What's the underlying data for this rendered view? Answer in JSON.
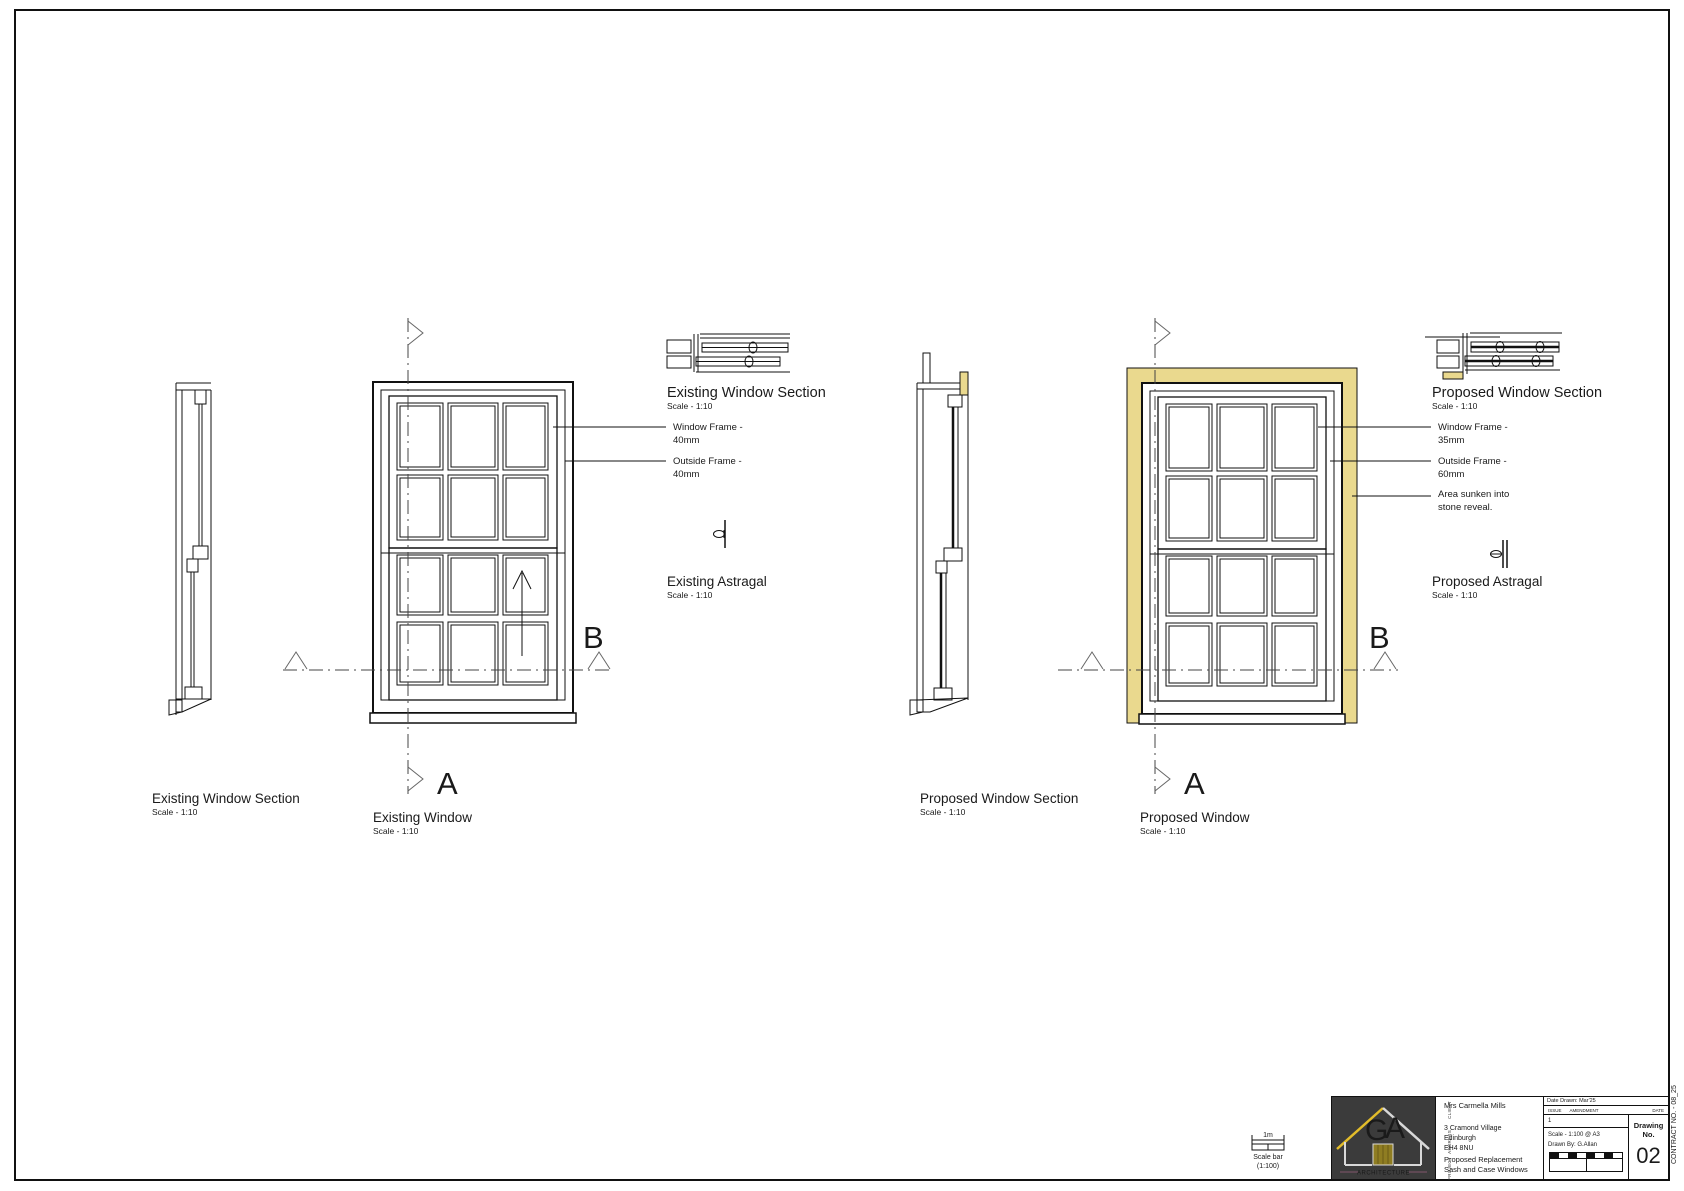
{
  "sheet": {
    "contract_no": "CONTRACT NO. - 08_25"
  },
  "existing": {
    "section_side": {
      "title": "Existing Window Section",
      "scale": "Scale - 1:10"
    },
    "window": {
      "title": "Existing Window",
      "scale": "Scale - 1:10"
    },
    "section_top": {
      "title": "Existing Window Section",
      "scale": "Scale - 1:10"
    },
    "notes": {
      "window_frame_line1": "Window Frame -",
      "window_frame_line2": "40mm",
      "outside_frame_line1": "Outside Frame -",
      "outside_frame_line2": "40mm"
    },
    "astragal": {
      "title": "Existing Astragal",
      "scale": "Scale - 1:10"
    }
  },
  "proposed": {
    "section_side": {
      "title": "Proposed Window Section",
      "scale": "Scale - 1:10"
    },
    "window": {
      "title": "Proposed Window",
      "scale": "Scale - 1:10"
    },
    "section_top": {
      "title": "Proposed Window Section",
      "scale": "Scale - 1:10"
    },
    "notes": {
      "window_frame_line1": "Window Frame -",
      "window_frame_line2": "35mm",
      "outside_frame_line1": "Outside Frame -",
      "outside_frame_line2": "60mm",
      "reveal_line1": "Area sunken into",
      "reveal_line2": "stone reveal."
    },
    "astragal": {
      "title": "Proposed Astragal",
      "scale": "Scale - 1:10"
    }
  },
  "markers": {
    "section_a": "A",
    "section_b": "B"
  },
  "scale_bar": {
    "length": "1m",
    "caption1": "Scale bar",
    "caption2": "(1:100)"
  },
  "title_block": {
    "client_label": "CLIENT",
    "client": "Mrs Carmella Mills",
    "address_label": "ADDRESS",
    "address1": "3 Cramond Village",
    "address2": "Edinburgh",
    "address3": "EH4 8NU",
    "project_label": "PROJECT",
    "project1": "Proposed Replacement",
    "project2": "Sash and Case Windows",
    "date_drawn": "Date Drawn: Mar'25",
    "issue_header": "ISSUE",
    "amendment_header": "AMENDMENT",
    "date_header": "DATE",
    "issue_no": "1",
    "scale_note": "Scale - 1:100 @ A3",
    "drawn_by": "Drawn By: G.Allan",
    "drawing_no_label": "Drawing No.",
    "drawing_no": "02",
    "logo_letters_g": "G",
    "logo_letters_a": "A",
    "logo_subtitle": "ARCHITECTURE"
  },
  "colors": {
    "reveal_yellow": "#EAD98E",
    "logo_bg": "#3B3B3B",
    "logo_yellow": "#E2BC2A",
    "logo_purple": "#A06BB0",
    "logo_gray_purple": "#A7A0BA",
    "logo_subtitle_color": "#9B5F7D"
  }
}
